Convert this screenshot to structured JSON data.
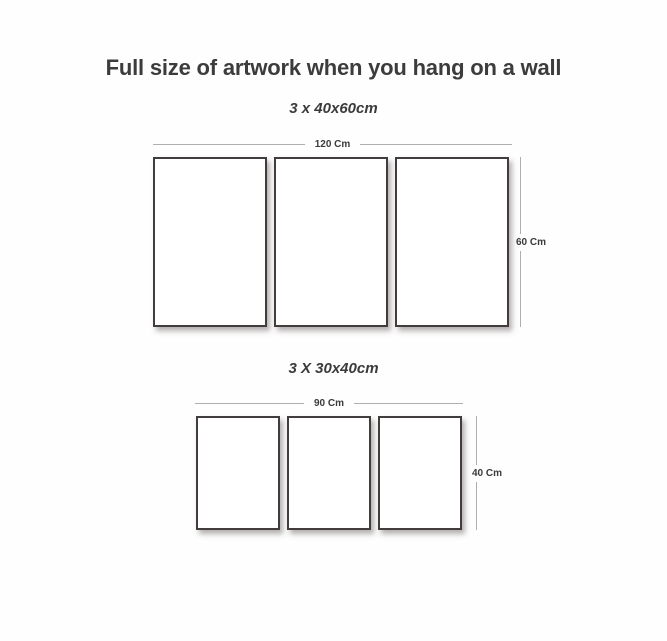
{
  "title": "Full size of artwork when you hang on a wall",
  "groups": [
    {
      "size_label": "3 x 40x60cm",
      "width_label": "120 Cm",
      "height_label": "60 Cm",
      "panel_count": 3
    },
    {
      "size_label": "3 X 30x40cm",
      "width_label": "90 Cm",
      "height_label": "40 Cm",
      "panel_count": 3
    }
  ],
  "colors": {
    "text": "#3c3c3c",
    "panel_border": "#413d3c",
    "dimension_line": "#b2aeae",
    "background": "#fefefe"
  }
}
